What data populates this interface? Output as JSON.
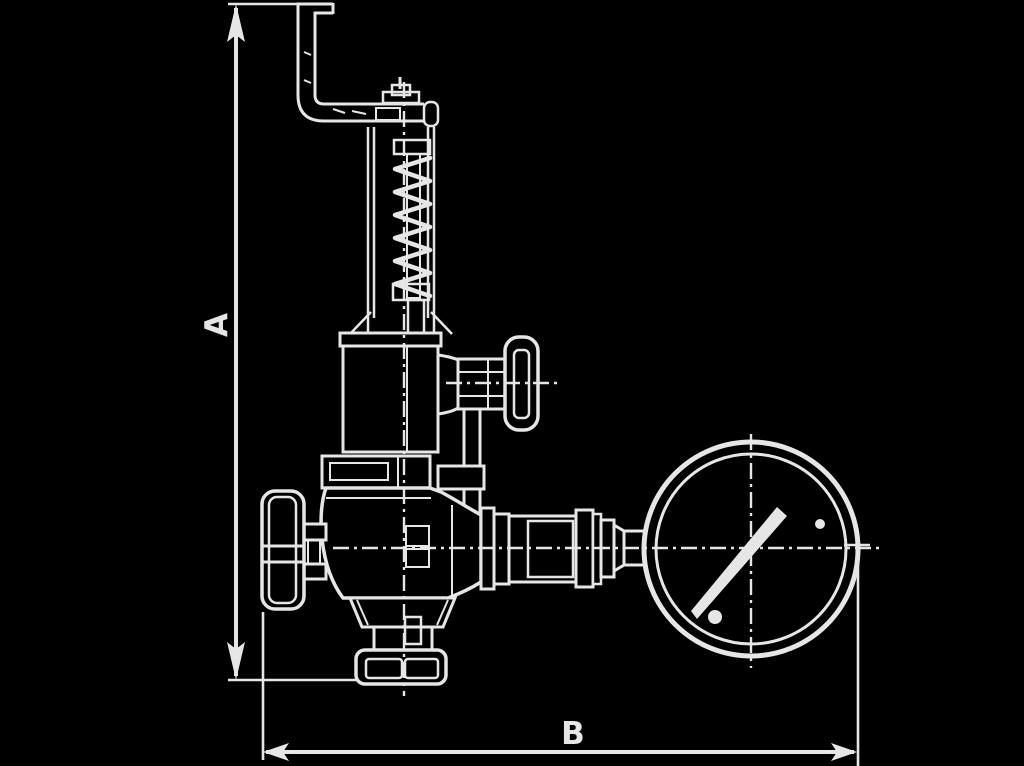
{
  "colors": {
    "background": "#000000",
    "ink": "#e6e6e6"
  },
  "dimension_labels": {
    "a": "A",
    "b": "B"
  },
  "figure": {
    "kind": "technical-line-drawing",
    "components": [
      "bent-lever-pipe",
      "spring-yoke",
      "coil-spring",
      "bonnet",
      "side-shutoff-handwheel",
      "main-valve-body",
      "left-handwheel",
      "bottom-outlet-flange",
      "coupling-pipe",
      "pressure-gauge"
    ]
  }
}
